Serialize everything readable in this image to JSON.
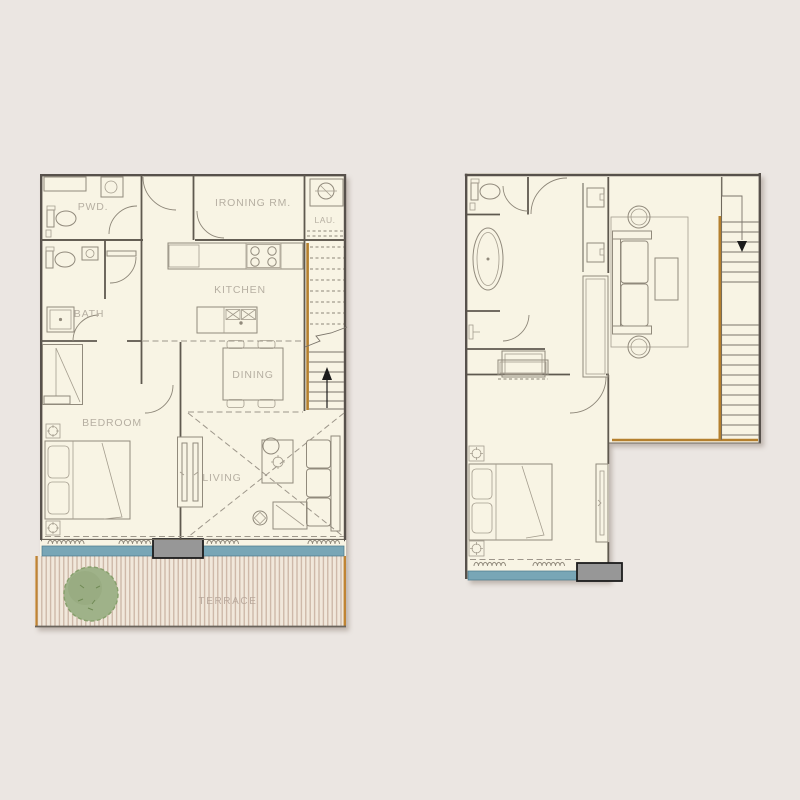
{
  "page": {
    "background": "#ebe6e2",
    "description_domain": "architectural-floor-plan"
  },
  "palette": {
    "floor_cream": "#f8f4e4",
    "wall_dark": "#57514b",
    "furniture_line": "#918a7c",
    "label_text": "#b6afa2",
    "stair_wood_orange": "#b5802e",
    "terrace_deck": "#f1e8db",
    "deck_stripe": "#c8b2a1",
    "deck_edge_orange": "#c08433",
    "tree_green": "#9fb289",
    "tree_green_dark": "#93a87c",
    "window_sill_blue": "#78a6b6",
    "threshold_gray": "#979797",
    "threshold_border": "#1c1c1c"
  },
  "lower_plan": {
    "labels": {
      "pwd": "PWD.",
      "ironing_room": "IRONING RM.",
      "laundry": "LAU.",
      "kitchen": "KITCHEN",
      "bath": "BATH",
      "dining": "DINING",
      "bedroom": "BEDROOM",
      "living": "LIVING",
      "terrace": "TERRACE"
    },
    "stair_direction": "up",
    "fixtures": [
      "toilet",
      "powder-sink",
      "washing-machine",
      "stove-4-burner",
      "kitchen-island-double-sink",
      "dining-table-4-chairs",
      "shower-tray",
      "closet",
      "double-bed",
      "ceiling-light",
      "sliding-door",
      "sofa",
      "ottoman",
      "side-table",
      "round-table",
      "floor-lamp",
      "stairs-up-arrow",
      "balcony-threshold",
      "window-sill",
      "terrace-decking",
      "terrace-tree",
      "curtain-waves"
    ]
  },
  "upper_plan": {
    "labels": {},
    "stair_direction": "down",
    "fixtures": [
      "toilet",
      "freestanding-bathtub",
      "shower",
      "double-vanity-sinks",
      "hanger-wardrobe",
      "hanger-closet",
      "sofa",
      "round-side-tables",
      "coffee-table",
      "rug",
      "double-bed",
      "ceiling-light",
      "sliding-window",
      "stairs-down-arrow",
      "balcony-threshold",
      "window-sill",
      "void-balustrade",
      "curtain-waves"
    ]
  }
}
